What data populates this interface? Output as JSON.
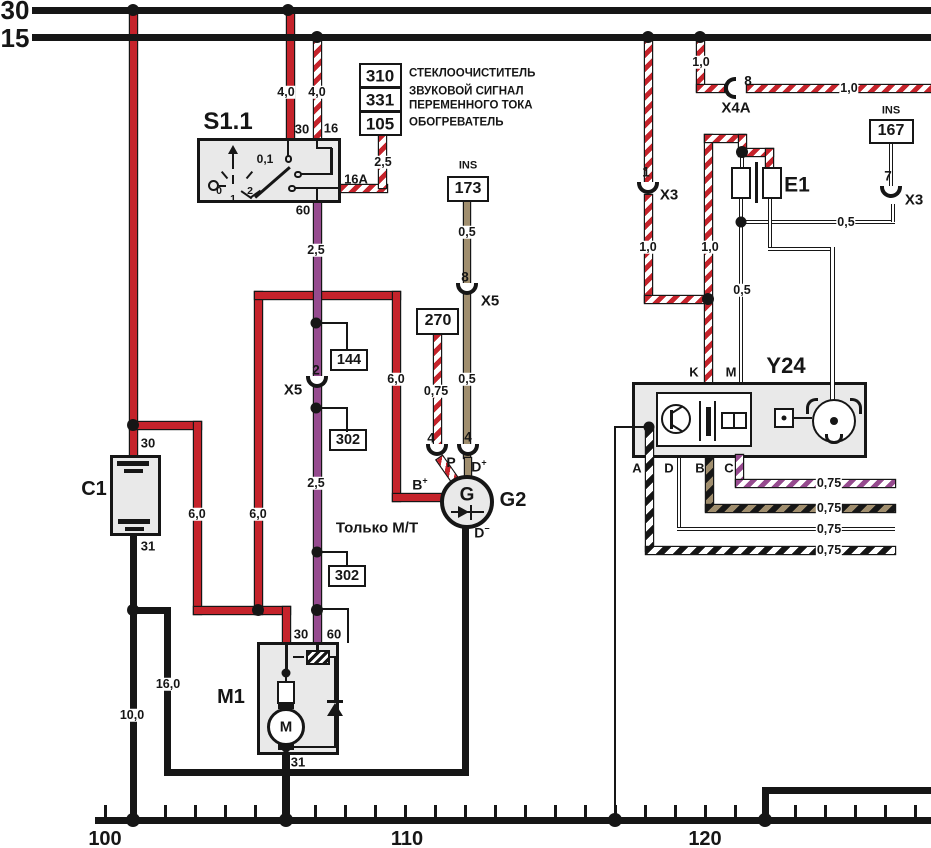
{
  "buses": {
    "b30": "30",
    "b15": "15"
  },
  "ruler": {
    "m100": "100",
    "m110": "110",
    "m120": "120"
  },
  "s11": {
    "name": "S1.1",
    "t30": "30",
    "t16": "16",
    "t16a": "16A",
    "t60": "60",
    "pos01": "0,1",
    "p0": "0",
    "p1": "1",
    "p2": "2"
  },
  "c1": {
    "name": "C1",
    "t30": "30",
    "t31": "31"
  },
  "m1": {
    "name": "M1",
    "t30": "30",
    "t60": "60",
    "t31": "31",
    "motor": "M"
  },
  "g2": {
    "name": "G2",
    "gen": "G",
    "b": "B",
    "bsup": "+",
    "dp": "D",
    "dpsup": "+",
    "dm": "D",
    "dmsup": "−",
    "p": "P"
  },
  "y24": {
    "name": "Y24",
    "tk": "K",
    "tm": "M",
    "ta": "A",
    "td": "D",
    "tb": "B",
    "tc": "C"
  },
  "e1": {
    "name": "E1"
  },
  "refs": {
    "r310": "310",
    "r331": "331",
    "r105": "105",
    "lbl310": "СТЕКЛООЧИСТИТЕЛЬ",
    "lbl331a": "ЗВУКОВОЙ СИГНАЛ",
    "lbl331b": "ПЕРЕМЕННОГО ТОКА",
    "lbl105": "ОБОГРЕВАТЕЛЬ",
    "ins1": "INS",
    "r173": "173",
    "ins2": "INS",
    "r167": "167",
    "r270": "270",
    "r144": "144",
    "r302a": "302",
    "r302b": "302"
  },
  "connectors": {
    "x5a_pin": "2",
    "x5a": "X5",
    "x5b_pin": "8",
    "x5b": "X5",
    "x3a_pin": "1",
    "x3a": "X3",
    "x3b_pin": "7",
    "x3b": "X3",
    "x4a_pin": "8",
    "x4a": "X4A",
    "p4": "4",
    "d4": "4"
  },
  "gauges": {
    "g40a": "4,0",
    "g40b": "4,0",
    "g25a": "2,5",
    "g25b": "2,5",
    "g25c": "2,5",
    "g60a": "6,0",
    "g60b": "6,0",
    "g60c": "6,0",
    "g100": "10,0",
    "g160": "16,0",
    "g05a": "0,5",
    "g05b": "0,5",
    "g05c": "0,5",
    "g05d": "0,5",
    "g075a": "0,75",
    "g075b": "0,75",
    "g075c": "0,75",
    "g075d": "0,75",
    "g075e": "0,75",
    "g10a": "1,0",
    "g10b": "1,0",
    "g10c": "1,0",
    "g10d": "1,0"
  },
  "notes": {
    "mt": "Только М/Т"
  },
  "colors": {
    "red": "#c5232b",
    "purple": "#964b8f",
    "tan": "#a08e6e",
    "black": "#161616"
  }
}
